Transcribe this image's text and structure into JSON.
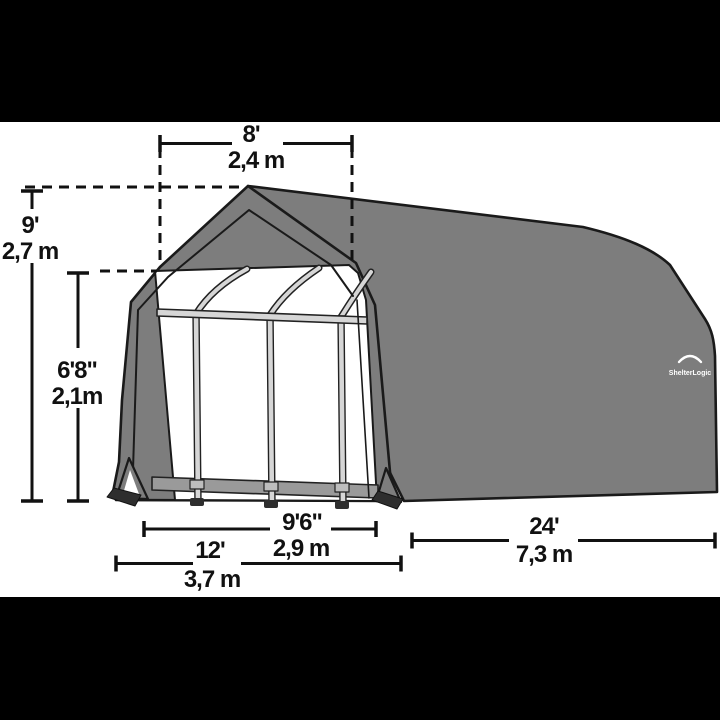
{
  "image": {
    "kind": "product-dimension-diagram",
    "subject": "barn-style fabric shelter garage",
    "background": "#ffffff",
    "letterbox_color": "#000000"
  },
  "brand": {
    "logo_text": "ShelterLogic"
  },
  "colors": {
    "cover_gray": "#7d7d7d",
    "outline": "#1a1a1a",
    "frame_tube": "#d6d6d6",
    "base_rail": "#9a9a9a",
    "foot_dark": "#2e2e2e",
    "dimension_ink": "#111111"
  },
  "dimensions": {
    "roof_top_width": {
      "imperial": "8'",
      "metric": "2,4 m"
    },
    "peak_height": {
      "imperial": "9'",
      "metric": "2,7 m"
    },
    "door_height": {
      "imperial": "6'8\"",
      "metric": "2,1m"
    },
    "door_width": {
      "imperial": "9'6\"",
      "metric": "2,9 m"
    },
    "frame_width": {
      "imperial": "12'",
      "metric": "3,7 m"
    },
    "frame_length": {
      "imperial": "24'",
      "metric": "7,3 m"
    }
  }
}
